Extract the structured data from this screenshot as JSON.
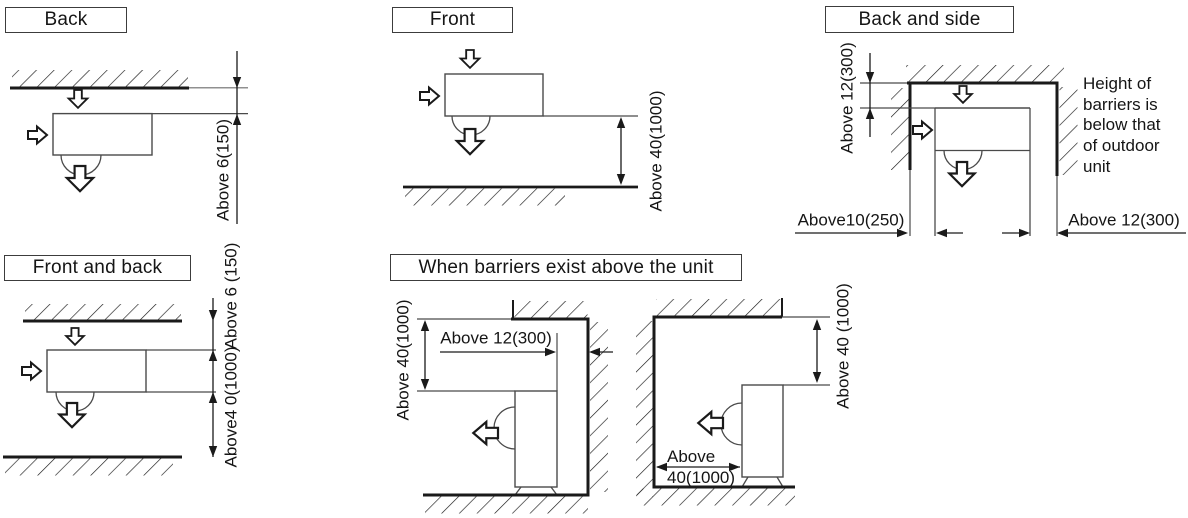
{
  "panels": {
    "back": {
      "title": "Back",
      "dim_clearance": "Above 6(150)"
    },
    "front": {
      "title": "Front",
      "dim_clearance": "Above 40(1000)"
    },
    "back_and_side": {
      "title": "Back and side",
      "dim_top": "Above 12(300)",
      "dim_bottom_left": "Above10(250)",
      "dim_bottom_right": "Above 12(300)",
      "note": "Height of\nbarriers is\nbelow that\nof outdoor\nunit"
    },
    "front_and_back": {
      "title": "Front and back",
      "dim_top": "Above 6 (150)",
      "dim_bottom": "Above4 0(1000)"
    },
    "barriers_above": {
      "title": "When barriers exist above the unit",
      "left": {
        "dim_vertical": "Above 40(1000)",
        "dim_horizontal": "Above 12(300)"
      },
      "right": {
        "dim_vertical": "Above 40 (1000)",
        "dim_bottom": "Above\n40(1000)"
      }
    }
  },
  "colors": {
    "line": "#1a1a1a",
    "unit_line": "#4a4a4a",
    "background": "#ffffff"
  }
}
